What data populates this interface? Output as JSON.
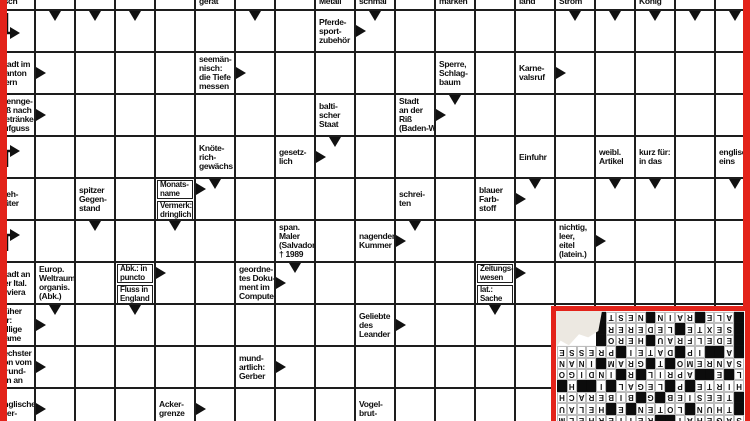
{
  "colors": {
    "frame_red": "#e3231a",
    "grid_line": "#1d1d1d"
  },
  "puzzle": {
    "grid": {
      "cols": 19,
      "rows": 11,
      "cell_w": 40,
      "cell_h": 42,
      "offset_x": -6,
      "offset_y": -33
    },
    "clues": [
      {
        "col": 0,
        "row": 0,
        "cut": "bottom",
        "lines": [
          "fisch"
        ]
      },
      {
        "col": 5,
        "row": 0,
        "cut": "bottom",
        "lines": [
          "gerät"
        ]
      },
      {
        "col": 8,
        "row": 0,
        "cut": "bottom",
        "lines": [
          "Metall"
        ]
      },
      {
        "col": 9,
        "row": 0,
        "cut": "bottom",
        "lines": [
          "schmal"
        ]
      },
      {
        "col": 11,
        "row": 0,
        "cut": "bottom",
        "lines": [
          "marken"
        ]
      },
      {
        "col": 13,
        "row": 0,
        "cut": "bottom",
        "lines": [
          "land"
        ]
      },
      {
        "col": 14,
        "row": 0,
        "cut": "bottom",
        "lines": [
          "Strom"
        ]
      },
      {
        "col": 16,
        "row": 0,
        "cut": "bottom",
        "lines": [
          "König"
        ]
      },
      {
        "col": 8,
        "row": 1,
        "lines": [
          "Pferde-",
          "sport-",
          "zubehör"
        ]
      },
      {
        "col": 0,
        "row": 2,
        "lines": [
          "Stadt im",
          "Kanton",
          "Bern"
        ]
      },
      {
        "col": 5,
        "row": 2,
        "lines": [
          "seemän-",
          "nisch:",
          "die Tiefe",
          "messen"
        ]
      },
      {
        "col": 11,
        "row": 2,
        "lines": [
          "Sperre,",
          "Schlag-",
          "baum"
        ]
      },
      {
        "col": 13,
        "row": 2,
        "lines": [
          "Karne-",
          "valsruf"
        ]
      },
      {
        "col": 0,
        "row": 3,
        "lines": [
          "Trennge-",
          "fäß nach",
          "Getränke-",
          "aufguss"
        ]
      },
      {
        "col": 8,
        "row": 3,
        "lines": [
          "balti-",
          "scher",
          "Staat"
        ]
      },
      {
        "col": 10,
        "row": 3,
        "lines": [
          "Stadt",
          "an der",
          "Riß",
          "(Baden-W.)"
        ]
      },
      {
        "col": 5,
        "row": 4,
        "lines": [
          "Knöte-",
          "rich-",
          "gewächs"
        ]
      },
      {
        "col": 7,
        "row": 4,
        "lines": [
          "gesetz-",
          "lich"
        ]
      },
      {
        "col": 13,
        "row": 4,
        "lines": [
          "Einfuhr"
        ]
      },
      {
        "col": 15,
        "row": 4,
        "lines": [
          "weibl.",
          "Artikel"
        ]
      },
      {
        "col": 16,
        "row": 4,
        "lines": [
          "kurz für:",
          "in das"
        ]
      },
      {
        "col": 18,
        "row": 4,
        "lines": [
          "englisch:",
          "eins"
        ]
      },
      {
        "col": 0,
        "row": 5,
        "lines": [
          "Vieh-",
          "hüter"
        ]
      },
      {
        "col": 2,
        "row": 5,
        "lines": [
          "spitzer",
          "Gegen-",
          "stand"
        ]
      },
      {
        "col": 4,
        "row": 5,
        "split": true,
        "top": [
          "Monats-",
          "name"
        ],
        "bottom": [
          "Vermerk:",
          "dringlich"
        ]
      },
      {
        "col": 10,
        "row": 5,
        "lines": [
          "schrei-",
          "ten"
        ]
      },
      {
        "col": 12,
        "row": 5,
        "lines": [
          "blauer",
          "Farb-",
          "stoff"
        ]
      },
      {
        "col": 7,
        "row": 6,
        "lines": [
          "span.",
          "Maler",
          "(Salvador)",
          "† 1989"
        ]
      },
      {
        "col": 9,
        "row": 6,
        "lines": [
          "nagender",
          "Kummer"
        ]
      },
      {
        "col": 14,
        "row": 6,
        "lines": [
          "nichtig,",
          "leer,",
          "eitel",
          "(latein.)"
        ]
      },
      {
        "col": 0,
        "row": 7,
        "lines": [
          "Stadt an",
          "der Ital.",
          "Riviera"
        ]
      },
      {
        "col": 1,
        "row": 7,
        "lines": [
          "Europ.",
          "Weltraum-",
          "organis.",
          "(Abk.)"
        ]
      },
      {
        "col": 3,
        "row": 7,
        "split": true,
        "top": [
          "Abk.: in",
          "puncto"
        ],
        "bottom": [
          "Fluss in",
          "England"
        ]
      },
      {
        "col": 6,
        "row": 7,
        "lines": [
          "geordne-",
          "tes Doku-",
          "ment im",
          "Computer"
        ]
      },
      {
        "col": 12,
        "row": 7,
        "split": true,
        "top": [
          "Zeitungs-",
          "wesen"
        ],
        "bottom": [
          "lat.:",
          "Sache"
        ]
      },
      {
        "col": 0,
        "row": 8,
        "lines": [
          "früher",
          "für:",
          "adlige",
          "Dame"
        ]
      },
      {
        "col": 9,
        "row": 8,
        "lines": [
          "Geliebte",
          "des",
          "Leander"
        ]
      },
      {
        "col": 0,
        "row": 9,
        "lines": [
          "sechster",
          "Ton vom",
          "Grund-",
          "ton an"
        ]
      },
      {
        "col": 6,
        "row": 9,
        "lines": [
          "mund-",
          "artlich:",
          "Gerber"
        ]
      },
      {
        "col": 0,
        "row": 10,
        "lines": [
          "englische",
          "Bier-"
        ]
      },
      {
        "col": 4,
        "row": 10,
        "lines": [
          "Acker-",
          "grenze"
        ]
      },
      {
        "col": 9,
        "row": 10,
        "lines": [
          "Vogel-",
          "brut-"
        ]
      }
    ],
    "arrows": [
      {
        "c": 0,
        "r": 1,
        "d": "bend-down"
      },
      {
        "c": 1,
        "r": 1,
        "d": "down"
      },
      {
        "c": 2,
        "r": 1,
        "d": "down"
      },
      {
        "c": 3,
        "r": 1,
        "d": "down"
      },
      {
        "c": 6,
        "r": 1,
        "d": "down"
      },
      {
        "c": 9,
        "r": 1,
        "d": "down"
      },
      {
        "c": 9,
        "r": 1,
        "d": "right"
      },
      {
        "c": 14,
        "r": 1,
        "d": "down"
      },
      {
        "c": 15,
        "r": 1,
        "d": "down"
      },
      {
        "c": 16,
        "r": 1,
        "d": "down"
      },
      {
        "c": 17,
        "r": 1,
        "d": "down"
      },
      {
        "c": 18,
        "r": 1,
        "d": "down"
      },
      {
        "c": 1,
        "r": 2,
        "d": "right"
      },
      {
        "c": 6,
        "r": 2,
        "d": "right"
      },
      {
        "c": 14,
        "r": 2,
        "d": "right"
      },
      {
        "c": 1,
        "r": 3,
        "d": "right"
      },
      {
        "c": 11,
        "r": 3,
        "d": "right"
      },
      {
        "c": 11,
        "r": 3,
        "d": "down"
      },
      {
        "c": 0,
        "r": 4,
        "d": "bend-up"
      },
      {
        "c": 8,
        "r": 4,
        "d": "right"
      },
      {
        "c": 8,
        "r": 4,
        "d": "down"
      },
      {
        "c": 5,
        "r": 5,
        "d": "down"
      },
      {
        "c": 5,
        "r": 5,
        "d": "right-top"
      },
      {
        "c": 13,
        "r": 5,
        "d": "down"
      },
      {
        "c": 13,
        "r": 5,
        "d": "right"
      },
      {
        "c": 15,
        "r": 5,
        "d": "down"
      },
      {
        "c": 16,
        "r": 5,
        "d": "down"
      },
      {
        "c": 18,
        "r": 5,
        "d": "down"
      },
      {
        "c": 0,
        "r": 6,
        "d": "bend-up"
      },
      {
        "c": 2,
        "r": 6,
        "d": "down"
      },
      {
        "c": 4,
        "r": 6,
        "d": "down"
      },
      {
        "c": 10,
        "r": 6,
        "d": "down"
      },
      {
        "c": 10,
        "r": 6,
        "d": "right"
      },
      {
        "c": 15,
        "r": 6,
        "d": "right"
      },
      {
        "c": 4,
        "r": 7,
        "d": "right-top"
      },
      {
        "c": 7,
        "r": 7,
        "d": "down"
      },
      {
        "c": 7,
        "r": 7,
        "d": "right"
      },
      {
        "c": 13,
        "r": 7,
        "d": "right-top"
      },
      {
        "c": 1,
        "r": 8,
        "d": "down"
      },
      {
        "c": 1,
        "r": 8,
        "d": "right"
      },
      {
        "c": 3,
        "r": 8,
        "d": "down"
      },
      {
        "c": 10,
        "r": 8,
        "d": "right"
      },
      {
        "c": 12,
        "r": 8,
        "d": "down"
      },
      {
        "c": 1,
        "r": 9,
        "d": "right"
      },
      {
        "c": 7,
        "r": 9,
        "d": "right"
      },
      {
        "c": 1,
        "r": 10,
        "d": "right"
      },
      {
        "c": 5,
        "r": 10,
        "d": "right"
      }
    ]
  },
  "solution": {
    "rows": [
      "SAGEHAI##REITERHELM",
      "#THUN#LOTEN#E#HELAU",
      "#TEESIEB#G#BIBERACH",
      "HIRTE#P#LEGAL#I##H#",
      "L#E##APRIL#R#INDIGO",
      "SANREMO#T#GRAM#INAN",
      "#A##IP#DATEI#PRESSE",
      "#EDELFRAU#HERO#    ",
      "#SEXTE#LEDERER#    ",
      "#ALE#RAIN#NEST#    "
    ]
  }
}
